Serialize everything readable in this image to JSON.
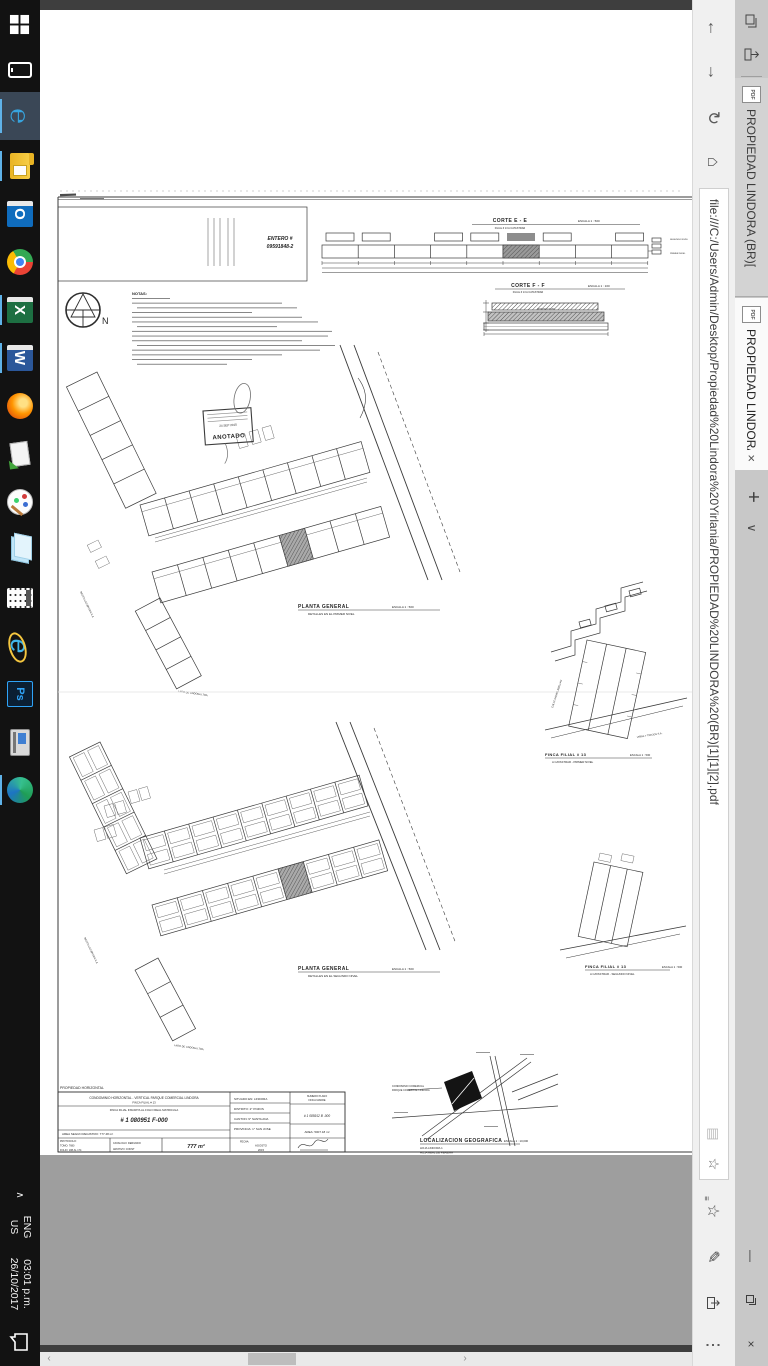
{
  "browser": {
    "tabs": [
      {
        "title": "PROPIEDAD LINDORA (BR)["
      },
      {
        "title": "PROPIEDAD LINDORA ("
      }
    ],
    "new_tab_label": "+",
    "url": "file:///C:/Users/Admin/Desktop/Propiedad%20Lindora%20Yirlania/PROPIEDAD%20LINDORA%20(BR)[1][1][2].pdf",
    "toolbar_icons": [
      "tabs-set-aside",
      "set-tabs-aside",
      "back",
      "forward",
      "refresh",
      "home",
      "reading-view",
      "favorite-star",
      "hub",
      "web-notes",
      "share",
      "more"
    ],
    "window_icons": [
      "minimize",
      "restore",
      "close"
    ]
  },
  "taskbar": {
    "icons": [
      "start",
      "tablet-device",
      "edge",
      "file-explorer",
      "outlook",
      "chrome",
      "excel",
      "word",
      "firefox",
      "mail",
      "paint",
      "photos",
      "calculator",
      "internet-explorer",
      "photoshop",
      "scanner",
      "maps-globe"
    ],
    "tray": {
      "lang1": "ENG",
      "lang2": "US",
      "time": "03:01 p.m.",
      "date": "26/10/2017"
    }
  },
  "sheet": {
    "entero": {
      "l1": "ENTERO #",
      "l2": "09591848-2"
    },
    "notas": "NOTAS:",
    "compass_n": "N",
    "levels": {
      "upper": "SEGUNDO NIVEL",
      "lower": "PRIMER NIVEL"
    },
    "corte_e": {
      "t": "CORTE E - E",
      "s": "ESCALA 1 : 500",
      "sub": "FILIAL # 13 A CATASTRAR"
    },
    "corte_f": {
      "t": "CORTE F - F",
      "s": "ESCALA 1 : 100",
      "sub": "FILIAL # 13 A CATASTRAR"
    },
    "anotado": {
      "date": "24 SEP 2015",
      "word": "ANOTADO"
    },
    "planta1": {
      "t": "PLANTA GENERAL",
      "s": "ESCALA 1 : 500",
      "sub": "DETALLES EN EL PRIMER NIVEL"
    },
    "planta2": {
      "t": "PLANTA GENERAL",
      "s": "ESCALA 1 : 500",
      "sub": "DETALLES EN EL SEGUNDO NIVEL"
    },
    "finca1": {
      "t": "FINCA FILIAL # 13",
      "s": "ESCALA 1 : 500",
      "sub": "A CATASTRAR  -  PRIMER NIVEL"
    },
    "finca2": {
      "t": "FINCA FILIAL # 13",
      "s": "ESCALA 1 : 500",
      "sub": "A CATASTRAR  -  SEGUNDO NIVEL"
    },
    "vecinos": {
      "resto": "RESTO LAS BRISAS S.A.",
      "lago": "LAGO DE LINDORA LTDA.",
      "vinas": "VIÑAS Y TREJOS S.A.",
      "calle": "CALLE DANIEL ABELLAN"
    },
    "mapa": {
      "t": "LOCALIZACION GEOGRAFICA",
      "s": "ESCALA 1 : 10,000",
      "h1": "HOJA LINDORA 1",
      "h2": "HOJA REAL DE PEREIRA",
      "p1": "CONDOMINIO COMERCIAL",
      "p2": "PARQUE COMERCIAL LINDORA"
    },
    "tb": {
      "header": "PROPIEDAD HORIZONTAL",
      "l1": "CONDOMINIO HORIZONTAL - VERTICAL PARQUE COMERCIAL LINDORA",
      "l2": "FINCA FILIAL # 13",
      "l3": "FINCA FILIAL INSCRITA AL FOLIO REAL MATRICULA",
      "plano": "# 1 080951 F-000",
      "area_reg": "AREA SEGUN REGISTRO: 777.48 m²",
      "situado": "SITUADO EN:  LINDORA",
      "distrito": "DISTRITO:  2° POZOS",
      "canton": "CANTON:  9° SANTA ANA",
      "provincia": "PROVINCIA:  1° SAN JOSE",
      "nm1": "NUMERO PLANO",
      "nm2": "FINCA MADRE",
      "plano_madre": "# 1 085912 B -000",
      "area_madre": "AREA:  5007.18 m²",
      "protocolo": "PROTOCOLO:",
      "tomo": "TOMO:  7680",
      "folio": "FOLIO:  188 AL 174",
      "catalogo": "CATALOGO:  DERIVADO",
      "archivo": "ARCHIVO:  CONST",
      "area": "777 m²",
      "fecha1": "FECHA:",
      "fecha2": "AGOSTO",
      "fecha3": "2015"
    }
  },
  "colors": {
    "accent_run": "#5fb2e8",
    "tab_active": "#fafafa",
    "tab_bar": "#c8c8c8",
    "pdf_bg": "#9e9e9e"
  }
}
